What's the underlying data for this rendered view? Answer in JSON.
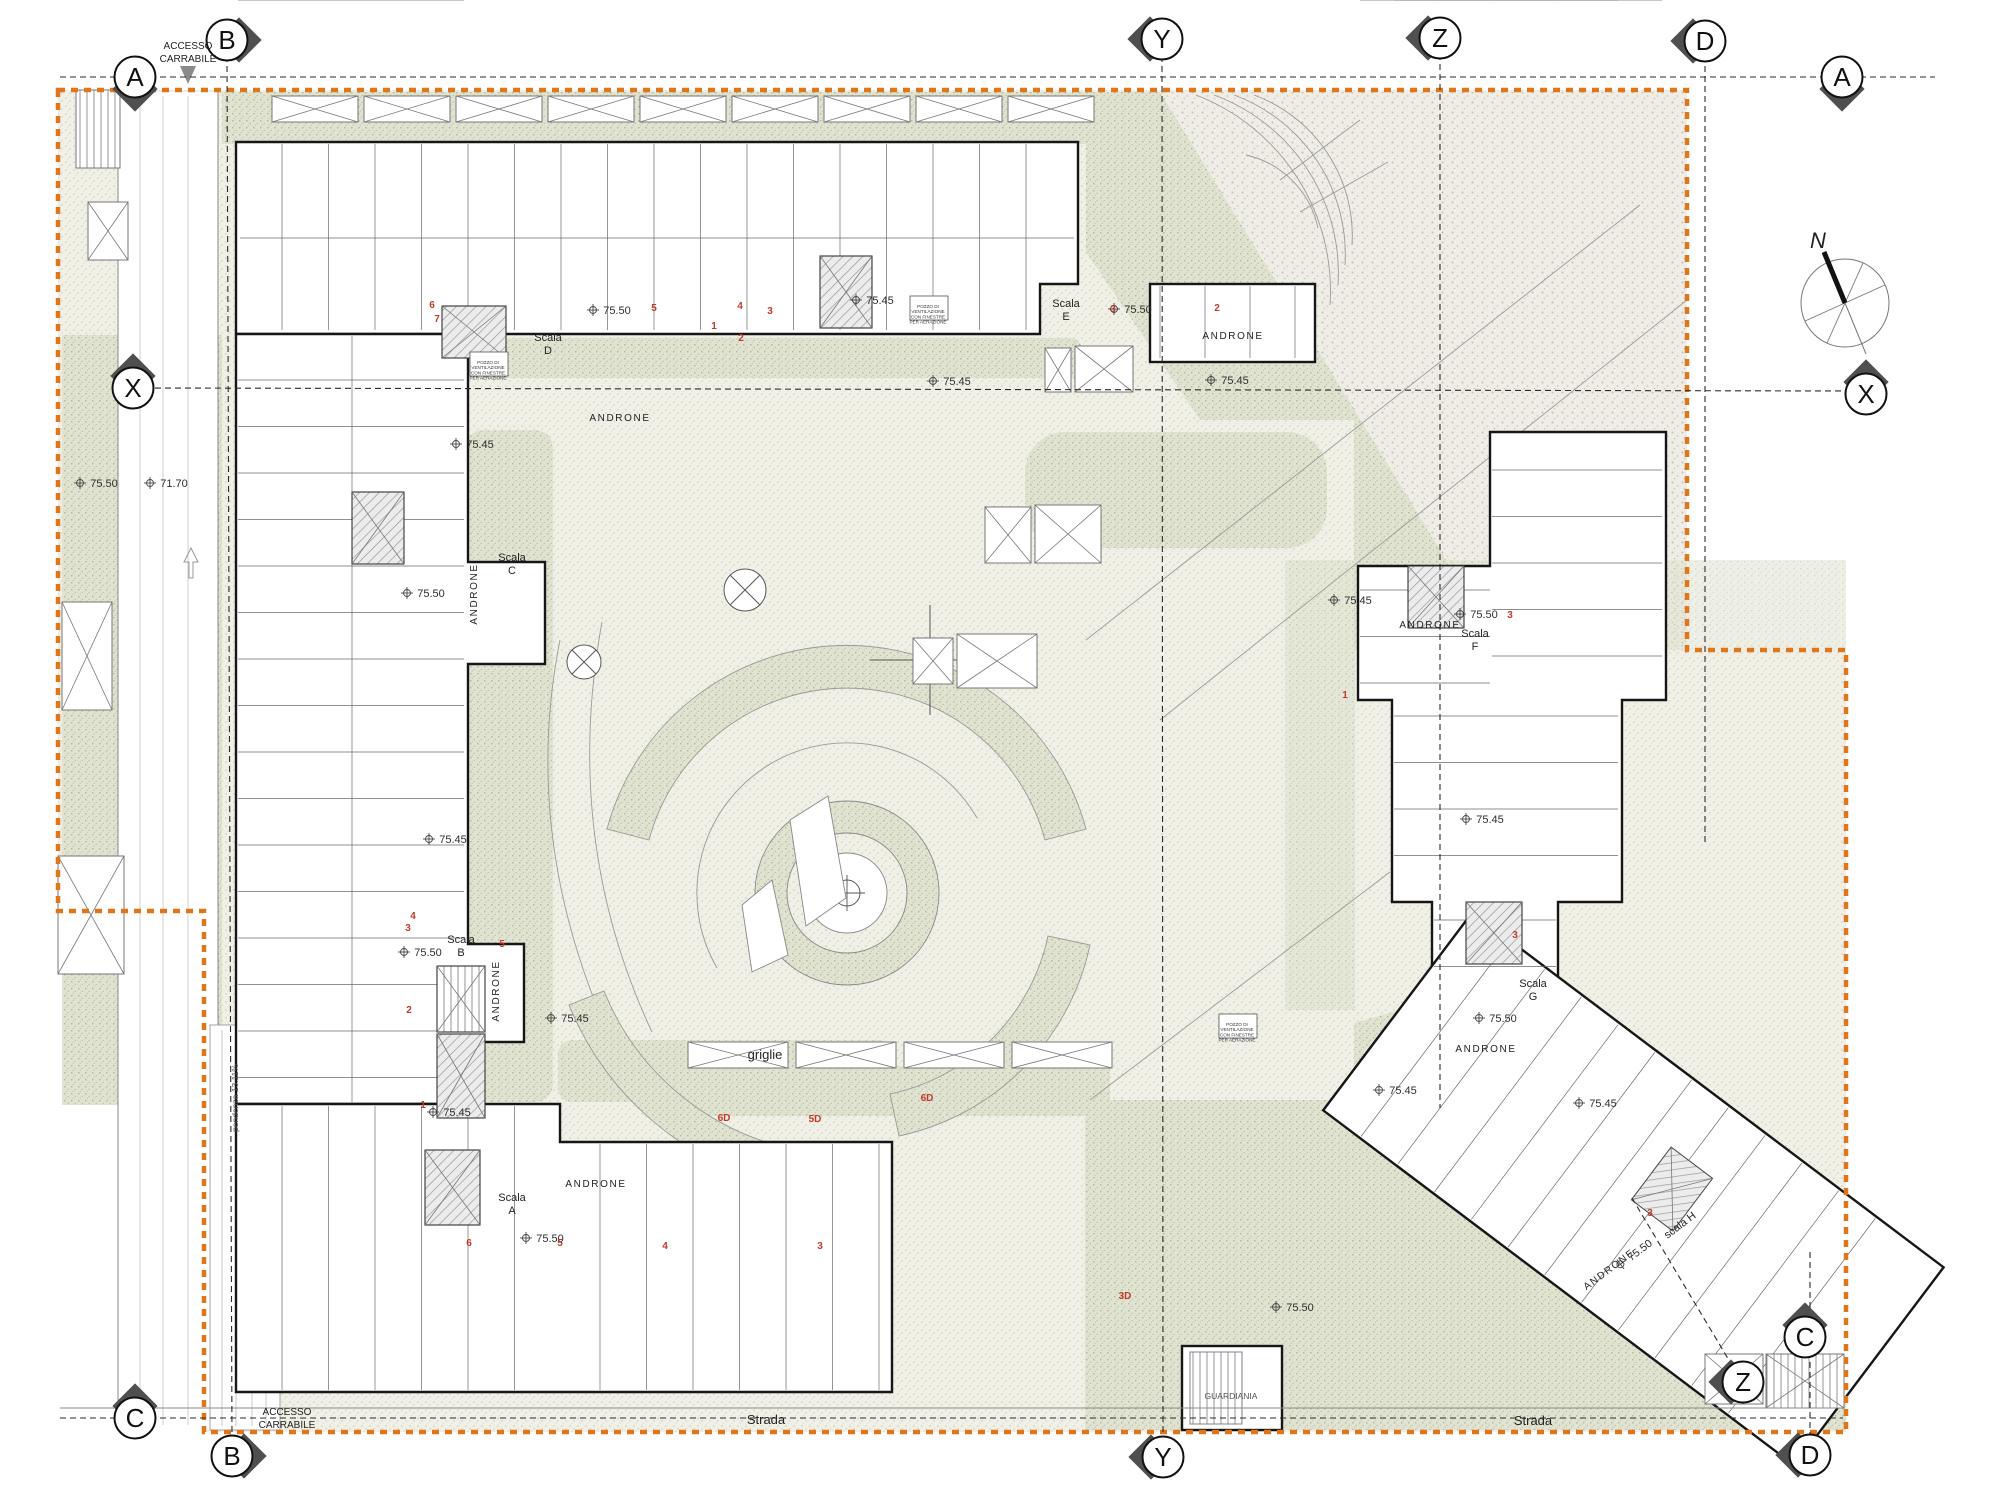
{
  "colors": {
    "accent_orange": "#E0761A",
    "ink": "#1a1a1a",
    "marker_gray": "#4f4f4f",
    "green_fill": "#e0e3d0",
    "green_dot": "#a9ad97",
    "cream_fill": "#f1f0e7",
    "cream_dot": "#ccc9b8",
    "coarse_fill": "#efede6",
    "coarse_dot": "#c4c0b4",
    "red": "#c03a2b",
    "line_gray": "#8f8f8f"
  },
  "compass": {
    "label": "N"
  },
  "grid_markers": [
    {
      "letter": "A",
      "x": 135,
      "y": 77,
      "dir": "down",
      "name": "grid-marker-a-left"
    },
    {
      "letter": "B",
      "x": 227,
      "y": 40,
      "dir": "right",
      "name": "grid-marker-b-top"
    },
    {
      "letter": "Y",
      "x": 1162,
      "y": 39,
      "dir": "left",
      "name": "grid-marker-y-top"
    },
    {
      "letter": "Z",
      "x": 1440,
      "y": 38,
      "dir": "left",
      "name": "grid-marker-z-top"
    },
    {
      "letter": "D",
      "x": 1705,
      "y": 41,
      "dir": "left",
      "name": "grid-marker-d-top"
    },
    {
      "letter": "A",
      "x": 1842,
      "y": 77,
      "dir": "down",
      "name": "grid-marker-a-right"
    },
    {
      "letter": "X",
      "x": 133,
      "y": 388,
      "dir": "up",
      "name": "grid-marker-x-left"
    },
    {
      "letter": "X",
      "x": 1866,
      "y": 394,
      "dir": "up",
      "name": "grid-marker-x-right"
    },
    {
      "letter": "C",
      "x": 135,
      "y": 1418,
      "dir": "up",
      "name": "grid-marker-c-left"
    },
    {
      "letter": "B",
      "x": 232,
      "y": 1456,
      "dir": "right",
      "name": "grid-marker-b-bottom"
    },
    {
      "letter": "Y",
      "x": 1163,
      "y": 1457,
      "dir": "left",
      "name": "grid-marker-y-bottom"
    },
    {
      "letter": "Z",
      "x": 1743,
      "y": 1382,
      "dir": "left",
      "name": "grid-marker-z-bottom"
    },
    {
      "letter": "C",
      "x": 1805,
      "y": 1337,
      "dir": "up",
      "name": "grid-marker-c-right"
    },
    {
      "letter": "D",
      "x": 1810,
      "y": 1455,
      "dir": "left",
      "name": "grid-marker-d-bottom"
    }
  ],
  "grid_lines": [
    {
      "x1": 60,
      "y1": 77,
      "x2": 1935,
      "y2": 77,
      "name": "axis-a"
    },
    {
      "x1": 145,
      "y1": 388,
      "x2": 1850,
      "y2": 391,
      "name": "axis-x"
    },
    {
      "x1": 60,
      "y1": 1418,
      "x2": 1843,
      "y2": 1418,
      "name": "axis-c-strada"
    },
    {
      "x1": 227,
      "y1": 56,
      "x2": 232,
      "y2": 1440,
      "name": "axis-b"
    },
    {
      "x1": 1162,
      "y1": 56,
      "x2": 1163,
      "y2": 1440,
      "name": "axis-y"
    },
    {
      "x1": 1440,
      "y1": 54,
      "x2": 1440,
      "y2": 1108,
      "name": "axis-z"
    },
    {
      "x1": 1632,
      "y1": 1198,
      "x2": 1736,
      "y2": 1372,
      "name": "axis-z-diagonal"
    },
    {
      "x1": 1705,
      "y1": 56,
      "x2": 1705,
      "y2": 845,
      "name": "axis-d"
    },
    {
      "x1": 1810,
      "y1": 1252,
      "x2": 1810,
      "y2": 1440,
      "name": "axis-d-lower"
    }
  ],
  "labels": [
    {
      "name": "accesso-carrabile-top",
      "text": "ACCESSO",
      "line2": "CARRABILE",
      "x": 188,
      "y": 49,
      "cls": "tiny"
    },
    {
      "name": "accesso-carrabile-bottom",
      "text": "ACCESSO",
      "line2": "CARRABILE",
      "x": 287,
      "y": 1415,
      "cls": "tiny"
    },
    {
      "name": "strada-label-left",
      "text": "Strada",
      "x": 766,
      "y": 1424,
      "cls": "small"
    },
    {
      "name": "strada-label-right",
      "text": "Strada",
      "x": 1533,
      "y": 1425,
      "cls": "small"
    },
    {
      "name": "griglie-label",
      "text": "griglie",
      "x": 765,
      "y": 1059,
      "cls": "small"
    },
    {
      "name": "guardiania-label",
      "text": "GUARDIANIA",
      "x": 1231,
      "y": 1399,
      "cls": "micro"
    },
    {
      "name": "pendenza-label",
      "text": "pendenza 13.11%",
      "x": 238,
      "y": 1098,
      "cls": "micro",
      "rot": -90
    },
    {
      "name": "north-label",
      "text": "N",
      "x": 1818,
      "y": 248,
      "cls": "nlab"
    },
    {
      "name": "scala-d-label",
      "text": "Scala",
      "line2": "D",
      "x": 548,
      "y": 341,
      "cls": "scala"
    },
    {
      "name": "scala-c-label",
      "text": "Scala",
      "line2": "C",
      "x": 512,
      "y": 561,
      "cls": "scala"
    },
    {
      "name": "scala-b-label",
      "text": "Scala",
      "line2": "B",
      "x": 461,
      "y": 943,
      "cls": "scala"
    },
    {
      "name": "scala-a-label",
      "text": "Scala",
      "line2": "A",
      "x": 512,
      "y": 1201,
      "cls": "scala"
    },
    {
      "name": "scala-e-label",
      "text": "Scala",
      "line2": "E",
      "x": 1066,
      "y": 307,
      "cls": "scala"
    },
    {
      "name": "scala-f-label",
      "text": "Scala",
      "line2": "F",
      "x": 1475,
      "y": 637,
      "cls": "scala"
    },
    {
      "name": "scala-g-label",
      "text": "Scala",
      "line2": "G",
      "x": 1533,
      "y": 987,
      "cls": "scala"
    },
    {
      "name": "scala-h-label",
      "text": "scala H",
      "x": 1682,
      "y": 1228,
      "cls": "scala",
      "rot": -37
    },
    {
      "name": "androne-d",
      "text": "ANDRONE",
      "x": 620,
      "y": 421,
      "cls": "andr"
    },
    {
      "name": "androne-c",
      "text": "ANDRONE",
      "x": 477,
      "y": 594,
      "cls": "andr",
      "rot": -90
    },
    {
      "name": "androne-b",
      "text": "ANDRONE",
      "x": 499,
      "y": 991,
      "cls": "andr",
      "rot": -90
    },
    {
      "name": "androne-a",
      "text": "ANDRONE",
      "x": 596,
      "y": 1187,
      "cls": "andr"
    },
    {
      "name": "androne-e",
      "text": "ANDRONE",
      "x": 1233,
      "y": 339,
      "cls": "andr"
    },
    {
      "name": "androne-f",
      "text": "ANDRONE",
      "x": 1430,
      "y": 628,
      "cls": "andr"
    },
    {
      "name": "androne-g",
      "text": "ANDRONE",
      "x": 1486,
      "y": 1052,
      "cls": "andr"
    },
    {
      "name": "androne-h",
      "text": "ANDRONE",
      "x": 1611,
      "y": 1272,
      "cls": "andr",
      "rot": -37
    },
    {
      "name": "elev",
      "text": "75.50",
      "x": 104,
      "y": 487,
      "cls": "elev",
      "sym": 1
    },
    {
      "name": "elev",
      "text": "71.70",
      "x": 174,
      "y": 487,
      "cls": "elev",
      "sym": 1
    },
    {
      "name": "elev",
      "text": "75.50",
      "x": 617,
      "y": 314,
      "cls": "elev",
      "sym": 1
    },
    {
      "name": "elev",
      "text": "75.45",
      "x": 880,
      "y": 304,
      "cls": "elev",
      "sym": 1
    },
    {
      "name": "elev",
      "text": "75.45",
      "x": 957,
      "y": 385,
      "cls": "elev",
      "sym": 1
    },
    {
      "name": "elev",
      "text": "75.45",
      "x": 480,
      "y": 448,
      "cls": "elev",
      "sym": 1
    },
    {
      "name": "elev",
      "text": "75.50",
      "x": 431,
      "y": 597,
      "cls": "elev",
      "sym": 1
    },
    {
      "name": "elev",
      "text": "75.45",
      "x": 453,
      "y": 843,
      "cls": "elev",
      "sym": 1
    },
    {
      "name": "elev",
      "text": "75.50",
      "x": 428,
      "y": 956,
      "cls": "elev",
      "sym": 1
    },
    {
      "name": "elev",
      "text": "75.45",
      "x": 457,
      "y": 1116,
      "cls": "elev",
      "sym": 1
    },
    {
      "name": "elev",
      "text": "75.45",
      "x": 575,
      "y": 1022,
      "cls": "elev",
      "sym": 1
    },
    {
      "name": "elev",
      "text": "75.50",
      "x": 550,
      "y": 1242,
      "cls": "elev",
      "sym": 1
    },
    {
      "name": "elev",
      "text": "75.50",
      "x": 1138,
      "y": 313,
      "cls": "elev",
      "sym": 1
    },
    {
      "name": "elev",
      "text": "75.45",
      "x": 1235,
      "y": 384,
      "cls": "elev",
      "sym": 1
    },
    {
      "name": "elev",
      "text": "75.45",
      "x": 1358,
      "y": 604,
      "cls": "elev",
      "sym": 1
    },
    {
      "name": "elev",
      "text": "75.50",
      "x": 1484,
      "y": 618,
      "cls": "elev",
      "sym": 1
    },
    {
      "name": "elev",
      "text": "75.45",
      "x": 1490,
      "y": 823,
      "cls": "elev",
      "sym": 1
    },
    {
      "name": "elev",
      "text": "75.45",
      "x": 1403,
      "y": 1094,
      "cls": "elev",
      "sym": 1
    },
    {
      "name": "elev",
      "text": "75.50",
      "x": 1503,
      "y": 1022,
      "cls": "elev",
      "sym": 1
    },
    {
      "name": "elev",
      "text": "75.45",
      "x": 1603,
      "y": 1107,
      "cls": "elev",
      "sym": 1
    },
    {
      "name": "elev",
      "text": "75.50",
      "x": 1642,
      "y": 1253,
      "cls": "elev",
      "rot": -37,
      "sym": 1
    },
    {
      "name": "elev",
      "text": "75.50",
      "x": 1300,
      "y": 1311,
      "cls": "elev",
      "sym": 1
    },
    {
      "name": "unit-no",
      "text": "6",
      "x": 432,
      "y": 308,
      "cls": "red"
    },
    {
      "name": "unit-no",
      "text": "7",
      "x": 437,
      "y": 322,
      "cls": "red"
    },
    {
      "name": "unit-no",
      "text": "5",
      "x": 654,
      "y": 311,
      "cls": "red"
    },
    {
      "name": "unit-no",
      "text": "4",
      "x": 740,
      "y": 309,
      "cls": "red"
    },
    {
      "name": "unit-no",
      "text": "1",
      "x": 714,
      "y": 329,
      "cls": "red"
    },
    {
      "name": "unit-no",
      "text": "2",
      "x": 741,
      "y": 341,
      "cls": "red"
    },
    {
      "name": "unit-no",
      "text": "3",
      "x": 770,
      "y": 314,
      "cls": "red"
    },
    {
      "name": "unit-no",
      "text": "3",
      "x": 1113,
      "y": 312,
      "cls": "red"
    },
    {
      "name": "unit-no",
      "text": "2",
      "x": 1217,
      "y": 311,
      "cls": "red"
    },
    {
      "name": "unit-no",
      "text": "5",
      "x": 502,
      "y": 947,
      "cls": "red"
    },
    {
      "name": "unit-no",
      "text": "2",
      "x": 409,
      "y": 1013,
      "cls": "red"
    },
    {
      "name": "unit-no",
      "text": "1",
      "x": 423,
      "y": 1108,
      "cls": "red"
    },
    {
      "name": "unit-no",
      "text": "4",
      "x": 413,
      "y": 919,
      "cls": "red"
    },
    {
      "name": "unit-no",
      "text": "3",
      "x": 408,
      "y": 931,
      "cls": "red"
    },
    {
      "name": "unit-no",
      "text": "6",
      "x": 469,
      "y": 1246,
      "cls": "red"
    },
    {
      "name": "unit-no",
      "text": "5",
      "x": 560,
      "y": 1246,
      "cls": "red"
    },
    {
      "name": "unit-no",
      "text": "4",
      "x": 665,
      "y": 1249,
      "cls": "red"
    },
    {
      "name": "unit-no",
      "text": "3",
      "x": 820,
      "y": 1249,
      "cls": "red"
    },
    {
      "name": "unit-no",
      "text": "6D",
      "x": 927,
      "y": 1101,
      "cls": "red"
    },
    {
      "name": "unit-no",
      "text": "5D",
      "x": 815,
      "y": 1122,
      "cls": "red"
    },
    {
      "name": "unit-no",
      "text": "6D",
      "x": 724,
      "y": 1121,
      "cls": "red"
    },
    {
      "name": "unit-no",
      "text": "3D",
      "x": 1125,
      "y": 1299,
      "cls": "red"
    },
    {
      "name": "unit-no",
      "text": "3",
      "x": 1510,
      "y": 618,
      "cls": "red"
    },
    {
      "name": "unit-no",
      "text": "1",
      "x": 1345,
      "y": 698,
      "cls": "red"
    },
    {
      "name": "unit-no",
      "text": "3",
      "x": 1515,
      "y": 938,
      "cls": "red"
    },
    {
      "name": "unit-no",
      "text": "3",
      "x": 1650,
      "y": 1216,
      "cls": "red"
    },
    {
      "name": "vent-note",
      "lines": [
        "POZZO DI",
        "VENTILAZIONE",
        "CON FINESTRE",
        "PER AERAZIONE"
      ],
      "x": 488,
      "y": 364,
      "cls": "vnote"
    },
    {
      "name": "vent-note",
      "lines": [
        "POZZO DI",
        "VENTILAZIONE",
        "CON FINESTRE",
        "PER AERAZIONE"
      ],
      "x": 928,
      "y": 308,
      "cls": "vnote"
    },
    {
      "name": "vent-note",
      "lines": [
        "POZZO DI",
        "VENTILAZIONE",
        "CON FINESTRE",
        "PER AERAZIONE"
      ],
      "x": 1237,
      "y": 1026,
      "cls": "vnote"
    }
  ]
}
